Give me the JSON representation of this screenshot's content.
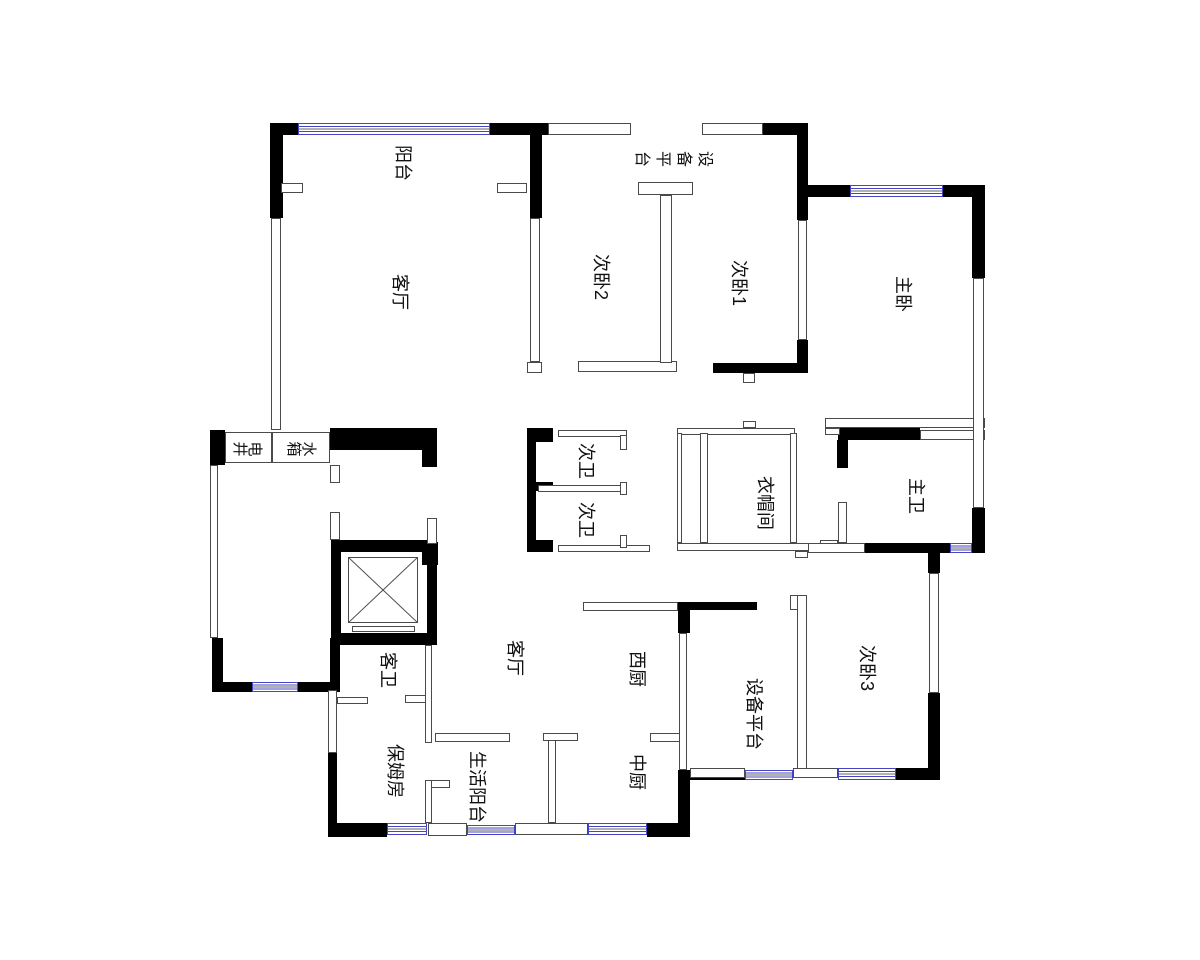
{
  "plan": {
    "title": "apartment floor plan",
    "rooms": [
      {
        "name": "balcony",
        "label": "阳台"
      },
      {
        "name": "living-room",
        "label": "客厅"
      },
      {
        "name": "bedroom-2",
        "label": "次卧2"
      },
      {
        "name": "equipment-platform-top",
        "label": "设备平台"
      },
      {
        "name": "bedroom-1",
        "label": "次卧1"
      },
      {
        "name": "master-bedroom",
        "label": "主卧"
      },
      {
        "name": "electric-shaft",
        "label": "电井"
      },
      {
        "name": "water-tank",
        "label": "水箱"
      },
      {
        "name": "bathroom-2-outer",
        "label": "次卫"
      },
      {
        "name": "bathroom-2-inner",
        "label": "次卫"
      },
      {
        "name": "walk-in-closet",
        "label": "衣帽间"
      },
      {
        "name": "master-bathroom",
        "label": "主卫"
      },
      {
        "name": "living-room-center",
        "label": "客厅"
      },
      {
        "name": "western-kitchen",
        "label": "西厨"
      },
      {
        "name": "bedroom-3",
        "label": "次卧3"
      },
      {
        "name": "equipment-platform-bottom",
        "label": "设备平台"
      },
      {
        "name": "guest-bathroom",
        "label": "客卫"
      },
      {
        "name": "nanny-room",
        "label": "保姆房"
      },
      {
        "name": "service-balcony",
        "label": "生活阳台"
      },
      {
        "name": "chinese-kitchen",
        "label": "中厨"
      }
    ],
    "symbols": {
      "elevator_shaft": "crossed-box"
    },
    "colors": {
      "wall": "#000000",
      "thin_line": "#4a4a4a",
      "window": "#4545c5",
      "background": "#ffffff",
      "text": "#111111"
    }
  }
}
